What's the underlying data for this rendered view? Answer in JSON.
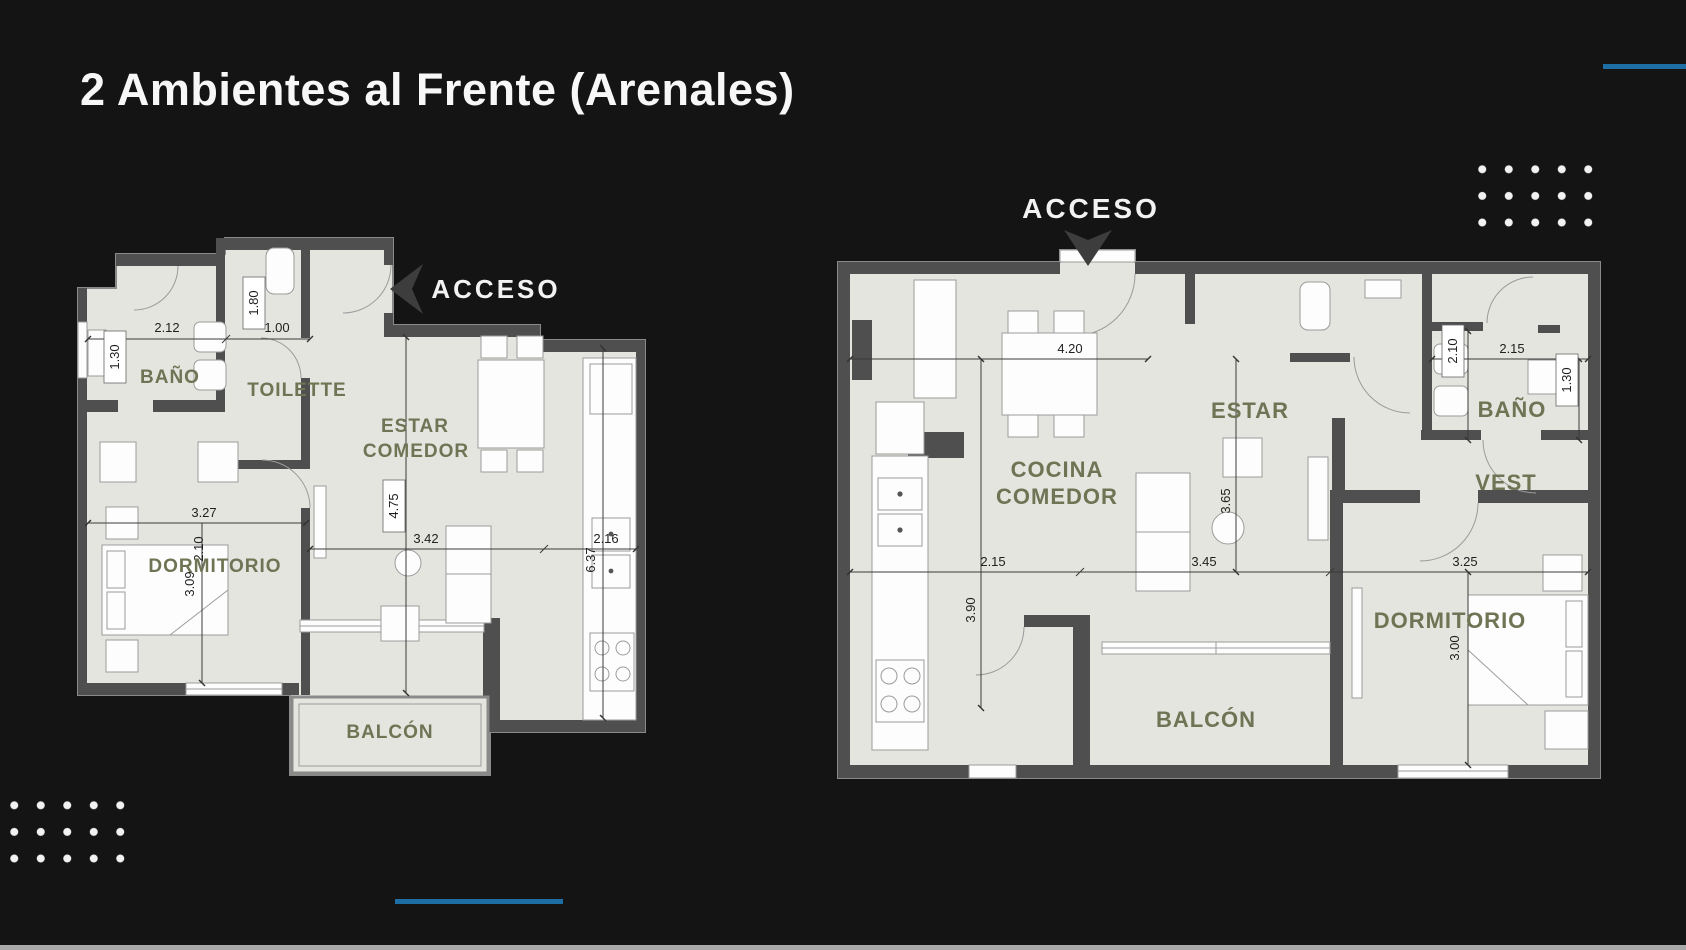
{
  "slide": {
    "title": "2 Ambientes al Frente (Arenales)"
  },
  "colors": {
    "background": "#141414",
    "accent_blue": "#1c6ea4",
    "wall": "#4f4f4f",
    "floor": "#e4e5df",
    "room_label": "#6e7454",
    "dimension_text": "#1f1f1f",
    "dots": "#f2f2f2",
    "bottom_bar": "#a8a8a8"
  },
  "plan_left": {
    "acceso": "ACCESO",
    "rooms": {
      "bano": "BAÑO",
      "toilette": "TOILETTE",
      "estar_line1": "ESTAR",
      "estar_line2": "COMEDOR",
      "dormitorio": "DORMITORIO",
      "balcon": "BALCÓN"
    },
    "dims": {
      "d212": "2.12",
      "d210": "2.10",
      "d180": "1.80",
      "d100": "1.00",
      "d130": "1.30",
      "d327": "3.27",
      "d309": "3.09",
      "d475": "4.75",
      "d342": "3.42",
      "d216": "2.16",
      "d637": "6.37"
    }
  },
  "plan_right": {
    "acceso": "ACCESO",
    "rooms": {
      "cocina_line1": "COCINA",
      "cocina_line2": "COMEDOR",
      "estar": "ESTAR",
      "bano": "BAÑO",
      "vest": "VEST",
      "dormitorio": "DORMITORIO",
      "balcon": "BALCÓN"
    },
    "dims": {
      "d420": "4.20",
      "d210": "2.10",
      "d215_bano": "2.15",
      "d130": "1.30",
      "d365": "3.65",
      "d215": "2.15",
      "d345": "3.45",
      "d325": "3.25",
      "d390": "3.90",
      "d300": "3.00"
    }
  }
}
